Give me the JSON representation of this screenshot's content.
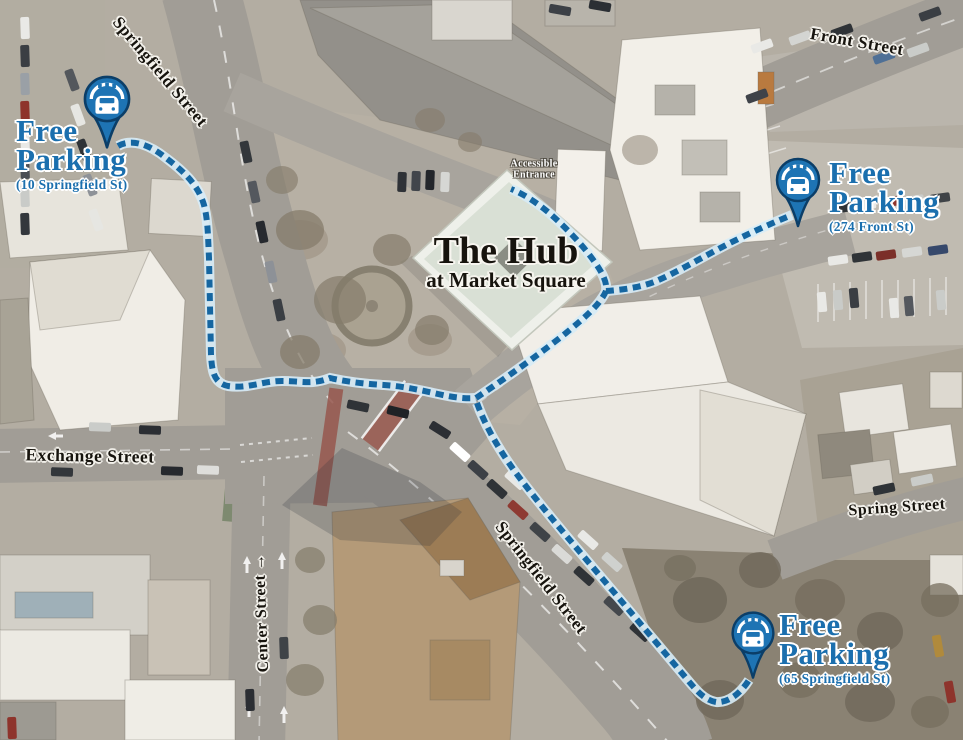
{
  "poi": {
    "title": "The Hub",
    "subtitle": "at Market Square"
  },
  "hub": {
    "entrance_line1": "Accessible",
    "entrance_line2": "Entrance"
  },
  "streets": {
    "springfield_upper": "Springfield Street",
    "front": "Front Street",
    "exchange": "Exchange Street",
    "center": "Center Street",
    "center_arrow": "→",
    "springfield_lower": "Springfield Street",
    "spring": "Spring Street"
  },
  "parking_markers": [
    {
      "title_line1": "Free",
      "title_line2": "Parking",
      "address": "(10 Springfield St)"
    },
    {
      "title_line1": "Free",
      "title_line2": "Parking",
      "address": "(274 Front St)"
    },
    {
      "title_line1": "Free",
      "title_line2": "Parking",
      "address": "(65 Springfield St)"
    }
  ],
  "icons": {
    "pin_glyph": "car-under-canopy-map-pin"
  },
  "colors": {
    "brand_blue": "#1b6fae",
    "pin_fill": "#1e74b4",
    "pin_outline": "#0b3e68",
    "route_dash": "#1566a1",
    "route_casing": "#d7ecf7",
    "street_label": "#17140e",
    "entrance_label": "#ffffff"
  }
}
